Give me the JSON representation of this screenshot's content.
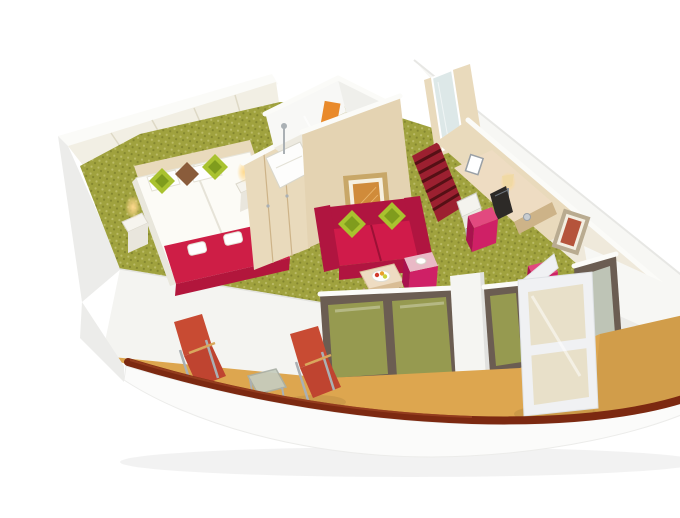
{
  "meta": {
    "description": "3D cutaway rendering of a wedge-shaped cruise ship balcony suite seen from above: bedroom with twin beds, bathroom block, entry corridor with red striped carpet, desk wall, red sofa lounge, glass balcony doors and a curved balcony with red deck loungers",
    "objects": [
      "twin-beds",
      "bed-runner",
      "bed-pillows",
      "nightstand-lamps",
      "wardrobe",
      "bathroom",
      "shower",
      "bathtub",
      "hand-towels",
      "entry-corridor",
      "striped-entry-carpet",
      "mirror-panel",
      "desk",
      "desk-lamp",
      "tv",
      "photo-frame",
      "desk-chair",
      "ottoman-cubes",
      "sofa",
      "sofa-pillows",
      "coffee-table",
      "fruit-plate",
      "cube-side-table",
      "wall-art-living-room",
      "wall-art-right-wall",
      "wall-sconce",
      "glass-balcony-doors",
      "open-glass-door",
      "balcony-floor",
      "deck-loungers",
      "balcony-side-table",
      "handrail",
      "hull-band"
    ]
  },
  "colors": {
    "background": "#ffffff",
    "shell_white": "#f7f7f4",
    "shell_shade": "#ececea",
    "shell_edge": "#e7e7e4",
    "slab": "#f4f4f1",
    "back_wall": "#f2efe4",
    "panel_line": "#ded9c6",
    "wood_light": "#e9dabc",
    "wood_mid": "#e4d3b2",
    "wood_dark": "#cdb388",
    "cream_wall": "#efe9db",
    "carpet": "#a0a23e",
    "carpet_light": "#c2c273",
    "carpet_dark": "#767a28",
    "glass_green": "#9aa050",
    "balcony_floor": "#dda64f",
    "handrail": "#7c2911",
    "hull_white": "#fbfbfa",
    "sofa_red": "#d01b4a",
    "sofa_red_dark": "#b01540",
    "sofa_red_deep": "#9c1136",
    "pillow_green": "#a9c22f",
    "pillow_green_dark": "#7f9c1d",
    "pillow_brown": "#8a5c3b",
    "bed_white": "#fcfbf6",
    "bed_shadow": "#e6e3d8",
    "runner_red": "#ce1e46",
    "runner_dark": "#b2163c",
    "pink": "#cf2066",
    "pink_light": "#e2497f",
    "pink_dark": "#a8134e",
    "pink_top": "#e9b9c6",
    "deck_chair": "#c84b33",
    "deck_chair_dark": "#bf4430",
    "metal": "#aab0b4",
    "glass_frame": "#6b5d52",
    "glass_sky": "#c6cdbf",
    "entry_carpet": "#9c2030",
    "entry_carpet_dark": "#551015",
    "towel_orange": "#e98a2b",
    "towel_yellow": "#e5c83e",
    "lamp_glow": "#ffd98d",
    "art_frame": "#c8a768",
    "art_amber": "#d08b3a",
    "art_red": "#b5543b",
    "mirror": "#dde8e8",
    "white_cap": "#fbfbf8",
    "table_wood": "#eedcc2",
    "door_white": "#f0f1f3"
  }
}
